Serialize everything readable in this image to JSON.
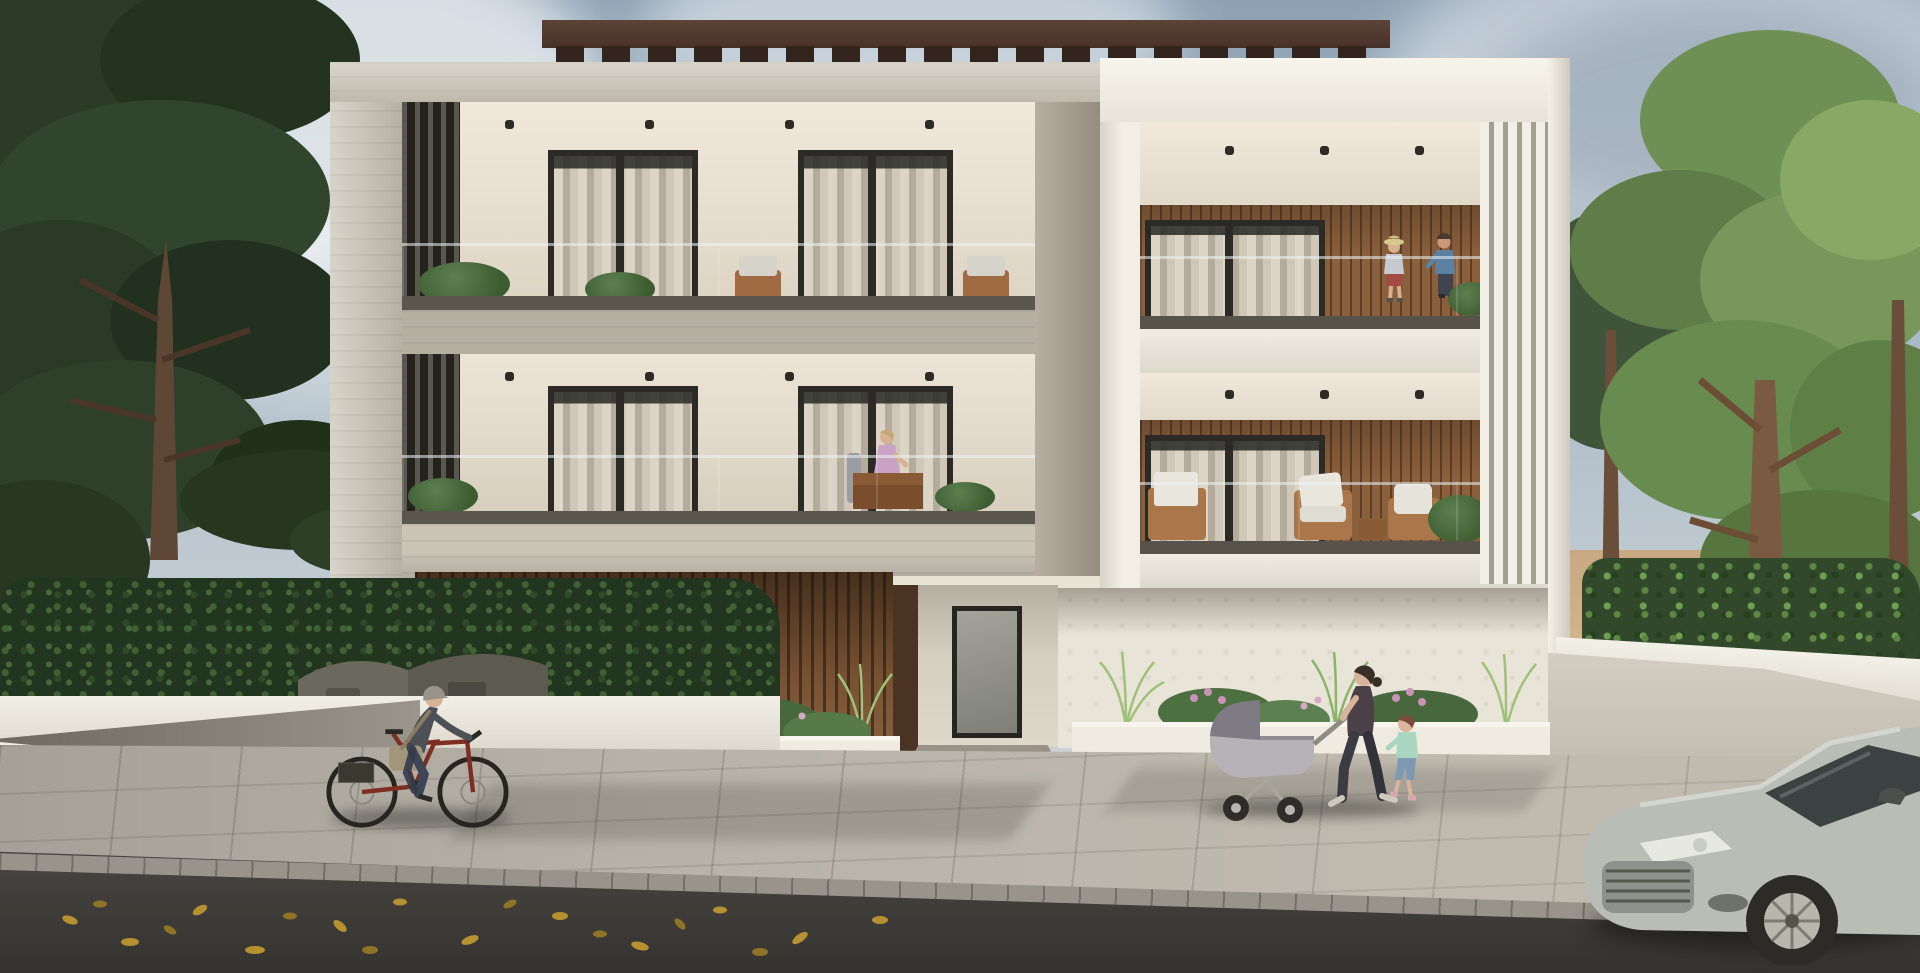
{
  "scene": {
    "description": "Photorealistic exterior render of a modern two-storey apartment building with balconies, street, pedestrians, a cyclist and a parked car",
    "sign": {
      "brand": "TOPCY",
      "number": "32"
    },
    "palette": {
      "sign_wave": "#2e6db4",
      "sign_text": "#241d17",
      "sky": "#a7b8c5",
      "concrete_frame": "#cbc5b7",
      "white_block": "#f2eee5",
      "wood_slats": "#8a5f3c",
      "pergola": "#46312a",
      "window_frame": "#2b2a26",
      "sidewalk": "#b8b3a9",
      "road": "#45423d",
      "car_body": "#b9bdb6",
      "bicycle_frame": "#7c2e22"
    },
    "entities": {
      "building": "two-storey residential block with glass balconies",
      "people": [
        "cyclist",
        "woman-with-stroller",
        "walking-child",
        "two-children-on-balcony",
        "seated-woman-on-balcony"
      ],
      "vehicles": [
        "parked-silver-car",
        "red-bicycle",
        "baby-stroller"
      ],
      "vegetation": [
        "dark-pine-trees-left",
        "green-trees-right",
        "hedges",
        "planter-grasses",
        "pink-flowers"
      ],
      "street": [
        "paved-sidewalk",
        "curb",
        "asphalt-road-with-fallen-leaves",
        "driveway",
        "white-garden-walls",
        "storage-bins"
      ]
    }
  }
}
